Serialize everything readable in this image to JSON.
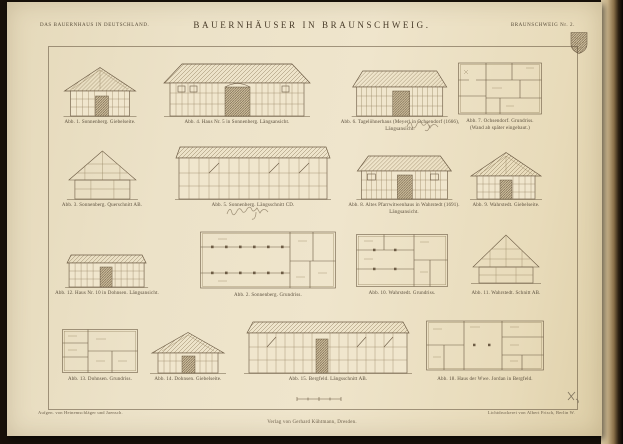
{
  "plate": {
    "series_title": "DAS BAUERNHAUS IN DEUTSCHLAND.",
    "title": "BAUERNHÄUSER IN BRAUNSCHWEIG.",
    "plate_number": "BRAUNSCHWEIG Nr. 2.",
    "credit_left": "Aufgen. von Heinemschläger und Jaensch.",
    "credit_right": "Lichtdruckerei von Albert Frisch, Berlin W.",
    "publisher_line": "Verlag von Gerhard Kühtmann, Dresden.",
    "colors": {
      "paper": "#ece2c8",
      "ink": "#6d5c45",
      "text": "#5a4e3c",
      "background": "#18110a"
    }
  },
  "figures": [
    {
      "id": "abb1",
      "caption": "Abb. 1.  Sonnenberg.  Giebelseite."
    },
    {
      "id": "abb4",
      "caption": "Abb. 4.  Haus Nr. 5 in Sonnenberg.  Längsansicht."
    },
    {
      "id": "abb6",
      "caption": "Abb. 6.  Tagelöhnerhaus (Meyer) in Ochsendorf (1666),",
      "caption2": "Längsansicht."
    },
    {
      "id": "abb7",
      "caption": "Abb. 7.  Ochsendorf.  Grundriss.",
      "caption2": "(Wand ab später eingebaut.)"
    },
    {
      "id": "abb3",
      "caption": "Abb. 3.  Sonnenberg.  Querschnitt AB."
    },
    {
      "id": "abb5",
      "caption": "Abb. 5.  Sonnenberg.  Längsschnitt CD."
    },
    {
      "id": "abb8",
      "caption": "Abb. 8.  Altes Pfarrwitwenhaus in Wahrstedt (1691).",
      "caption2": "Längsansicht."
    },
    {
      "id": "abb9",
      "caption": "Abb. 9.  Wahrstedt.  Giebelseite."
    },
    {
      "id": "abb12",
      "caption": "Abb. 12.  Haus Nr. 10 in Dohnsen.  Längsansicht."
    },
    {
      "id": "abb2",
      "caption": "Abb. 2.  Sonnenberg.  Grundriss."
    },
    {
      "id": "abb10",
      "caption": "Abb. 10.  Wahrstedt.  Grundriss."
    },
    {
      "id": "abb11",
      "caption": "Abb. 11.  Wahrstedt.  Schnitt AB."
    },
    {
      "id": "abb13",
      "caption": "Abb. 13.  Dohnsen.  Grundriss."
    },
    {
      "id": "abb14",
      "caption": "Abb. 14.  Dohnsen.  Giebelseite."
    },
    {
      "id": "abb15",
      "caption": "Abb. 15.  Bergfeld.  Längsschnitt AB."
    },
    {
      "id": "abb18",
      "caption": "Abb. 18.  Haus der Wwe. Jordan in Bergfeld."
    }
  ]
}
